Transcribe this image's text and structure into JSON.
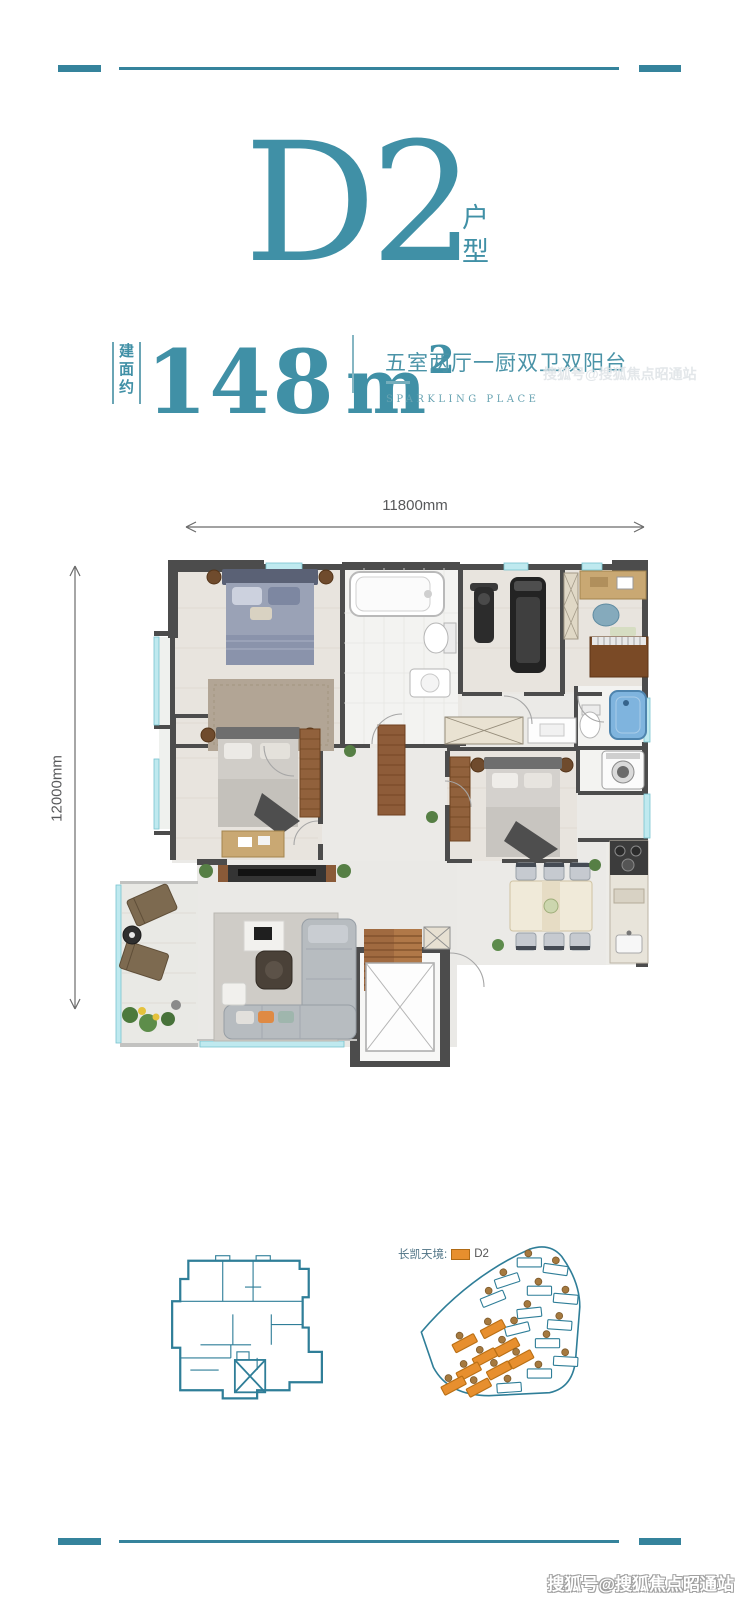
{
  "colors": {
    "teal": "#4090a6",
    "teal_line": "#35839c",
    "site_outline": "#2f7e98",
    "orange": "#e78f2e",
    "dim_text": "#58595b",
    "wall": "#4c4c4c"
  },
  "header": {
    "unit_name": "D2",
    "unit_label": "户型"
  },
  "stats": {
    "area_prefix": "建面约",
    "area_value": "148",
    "area_unit": "m",
    "area_exponent": "2",
    "layout_description": "五室两厅一厨双卫双阳台",
    "tagline": "SPARKLING PLACE"
  },
  "dimensions": {
    "width": "11800mm",
    "depth": "12000mm"
  },
  "site_plan": {
    "legend_project": "长凯天境:",
    "legend_unit": "D2",
    "buildings": [
      {
        "x": 140,
        "y": 26,
        "a": 0,
        "t": "std"
      },
      {
        "x": 166,
        "y": 33,
        "a": 8,
        "t": "std"
      },
      {
        "x": 118,
        "y": 44,
        "a": -18,
        "t": "std"
      },
      {
        "x": 150,
        "y": 54,
        "a": 0,
        "t": "std"
      },
      {
        "x": 176,
        "y": 62,
        "a": 5,
        "t": "std"
      },
      {
        "x": 104,
        "y": 62,
        "a": -22,
        "t": "std"
      },
      {
        "x": 140,
        "y": 76,
        "a": -6,
        "t": "std"
      },
      {
        "x": 170,
        "y": 88,
        "a": 4,
        "t": "std"
      },
      {
        "x": 128,
        "y": 92,
        "a": -14,
        "t": "std"
      },
      {
        "x": 158,
        "y": 106,
        "a": 0,
        "t": "std"
      },
      {
        "x": 176,
        "y": 124,
        "a": 3,
        "t": "std"
      },
      {
        "x": 150,
        "y": 136,
        "a": 0,
        "t": "std"
      },
      {
        "x": 120,
        "y": 150,
        "a": -4,
        "t": "std"
      },
      {
        "x": 104,
        "y": 92,
        "a": -28,
        "t": "d2"
      },
      {
        "x": 76,
        "y": 106,
        "a": -28,
        "t": "d2"
      },
      {
        "x": 96,
        "y": 120,
        "a": -28,
        "t": "d2"
      },
      {
        "x": 118,
        "y": 110,
        "a": -28,
        "t": "d2"
      },
      {
        "x": 132,
        "y": 122,
        "a": -28,
        "t": "d2"
      },
      {
        "x": 80,
        "y": 134,
        "a": -28,
        "t": "d2"
      },
      {
        "x": 110,
        "y": 133,
        "a": -28,
        "t": "d2"
      },
      {
        "x": 65,
        "y": 148,
        "a": -28,
        "t": "d2"
      },
      {
        "x": 90,
        "y": 150,
        "a": -28,
        "t": "d2"
      }
    ]
  },
  "watermark": {
    "text": "搜狐号@搜狐焦点昭通站"
  }
}
